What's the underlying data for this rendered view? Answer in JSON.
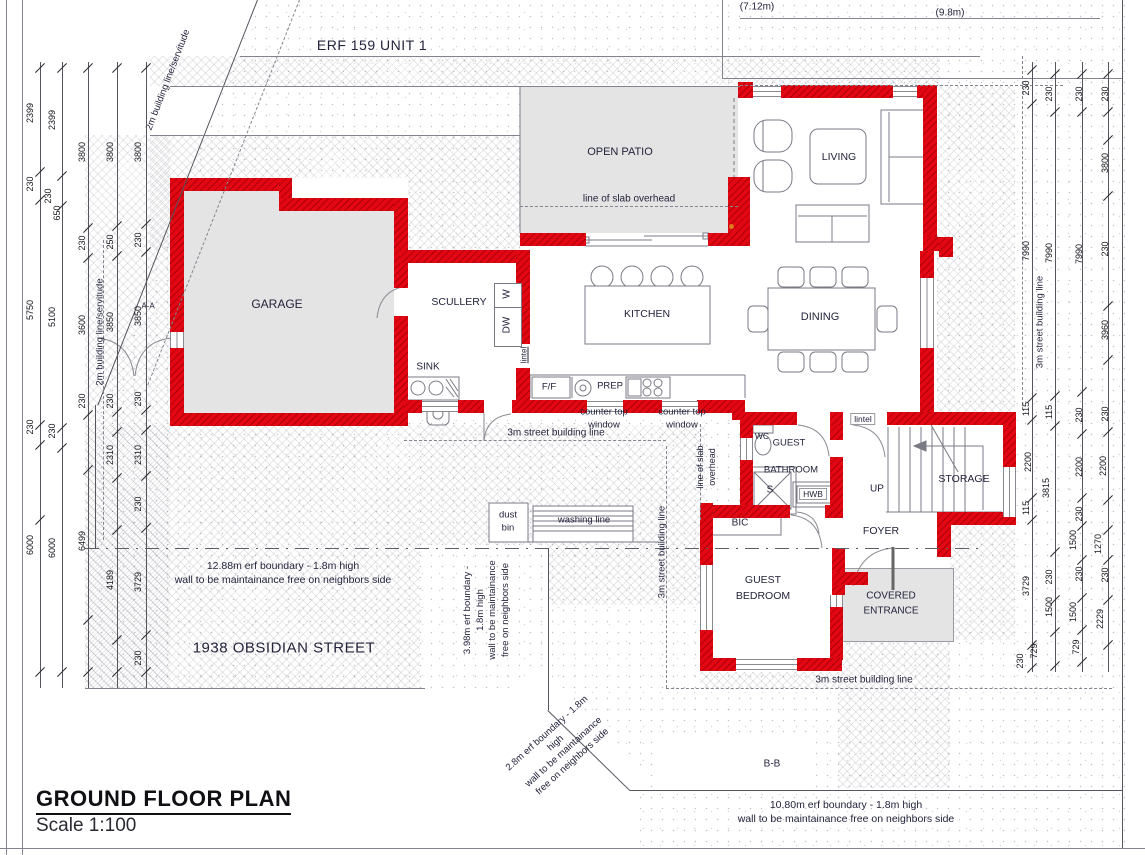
{
  "colors": {
    "wall_red": "#e30613",
    "slab_gray": "#e4e4e5",
    "accent_orange": "#e07820",
    "accent_green": "#2aa05a"
  },
  "plan": {
    "erf_label": "ERF 159 UNIT 1",
    "street_name": "1938 OBSIDIAN STREET",
    "title": "GROUND FLOOR PLAN",
    "scale": "Scale 1:100",
    "section_a": "A-A",
    "section_b": "B-B",
    "neighbor_dim_1": "(7.12m)",
    "neighbor_dim_2": "(9.8m)"
  },
  "rooms": {
    "garage": "GARAGE",
    "scullery": "SCULLERY",
    "kitchen": "KITCHEN",
    "dining": "DINING",
    "living": "LIVING",
    "open_patio": "OPEN PATIO",
    "storage": "STORAGE",
    "foyer": "FOYER",
    "bic": "BIC",
    "up": "UP",
    "guest_bathroom_l1": "GUEST",
    "guest_bathroom_l2": "BATHROOM",
    "guest_bedroom_l1": "GUEST",
    "guest_bedroom_l2": "BEDROOM",
    "covered_entrance_l1": "COVERED",
    "covered_entrance_l2": "ENTRANCE"
  },
  "fixtures": {
    "sink": "SINK",
    "dishwasher": "DW",
    "washing_machine": "W",
    "fridge": "F/F",
    "prep": "PREP",
    "wc": "WC",
    "shower": "S",
    "hwb": "HWB",
    "dust_bin_l1": "dust",
    "dust_bin_l2": "bin",
    "washing_line": "washing line",
    "lintel": "lintel"
  },
  "annotations": {
    "slab_overhead": "line of slab  overhead",
    "slab_l1": "line of slab",
    "slab_l2": "overhead",
    "counter_window_l1": "counter top",
    "counter_window_l2": "window",
    "street_building_line": "3m street building line",
    "servitude_line": "2m building line/servitude",
    "b1288_l1": "12.88m erf boundary - 1.8m high",
    "b1288_l2": "wall to be maintainance free on neighbors side",
    "b1080_l1": "10.80m erf boundary - 1.8m high",
    "b1080_l2": "wall to be maintainance free on neighbors side",
    "b398_l1": "3.98m erf boundary -",
    "b398_l2": "1.8m high",
    "b398_l3": "wall to be maintainance",
    "b398_l4": "free on neighbors side",
    "b28_l1": "2.8m erf boundary - 1.8m",
    "b28_l2": "high",
    "b28_l3": "wall to be maintainance",
    "b28_l4": "free on neighbors side"
  },
  "dims": {
    "left": [
      "2399",
      "2399",
      "3800",
      "3800",
      "3800",
      "230",
      "230",
      "650",
      "230",
      "250",
      "230",
      "5750",
      "5100",
      "3600",
      "3850",
      "3850",
      "230",
      "230",
      "230",
      "230",
      "230",
      "2310",
      "2310",
      "230",
      "6000",
      "6000",
      "6499",
      "4189",
      "3729",
      "230"
    ],
    "right": [
      "230",
      "230",
      "230",
      "230",
      "3800",
      "7990",
      "7990",
      "7990",
      "230",
      "3960",
      "115",
      "115",
      "230",
      "230",
      "2200",
      "3815",
      "2200",
      "2200",
      "115",
      "230",
      "1500",
      "1270",
      "3729",
      "230",
      "230",
      "230",
      "1500",
      "1500",
      "2229",
      "230",
      "729",
      "729"
    ]
  }
}
